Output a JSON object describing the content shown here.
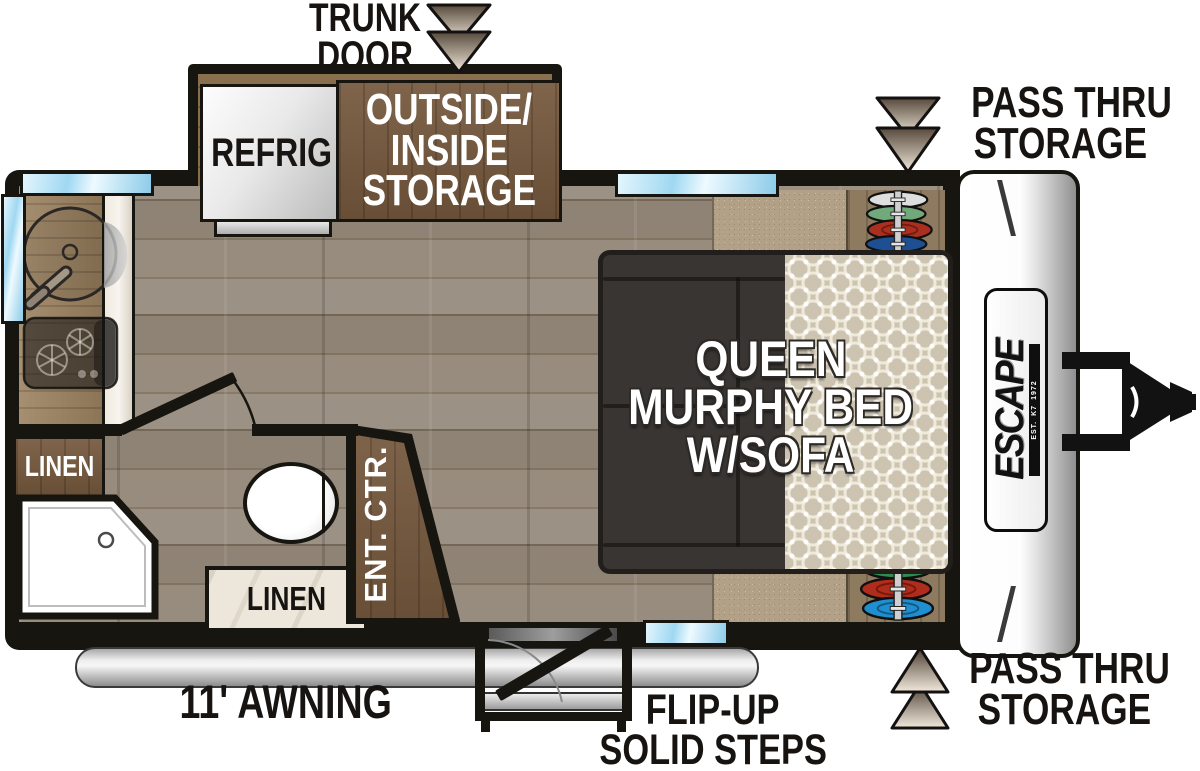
{
  "exterior": {
    "trunk_door": {
      "line1": "TRUNK",
      "line2": "DOOR"
    },
    "pass_thru_top": {
      "line1": "PASS THRU",
      "line2": "STORAGE"
    },
    "pass_thru_bottom": {
      "line1": "PASS THRU",
      "line2": "STORAGE"
    },
    "awning": "11' AWNING",
    "steps": {
      "line1": "FLIP-UP",
      "line2": "SOLID STEPS"
    }
  },
  "interior": {
    "refrigerator": "REFRIG",
    "storage": {
      "line1": "OUTSIDE/",
      "line2": "INSIDE",
      "line3": "STORAGE"
    },
    "bed": {
      "line1": "QUEEN",
      "line2": "MURPHY BED",
      "line3": "W/SOFA"
    },
    "linen_cabinet": "LINEN",
    "linen_counter": "LINEN",
    "entertainment_center": "ENT. CTR."
  },
  "brand": {
    "logo": "ESCAPE",
    "est": "EST.",
    "model_code": "K7",
    "year": "1972"
  },
  "colors": {
    "wall": "#17150f",
    "window_blue": "#9fd8f2",
    "cabinet_brown": "#74573c",
    "carpet_tan": "#b2a186",
    "sofa_dark": "#383532",
    "arrow_dark": "#574a3c",
    "arrow_light": "#f2e9dc",
    "disc_white": "#dedede",
    "disc_green_pale": "#72a97b",
    "disc_green": "#2f8c4f",
    "disc_red": "#ab2f1f",
    "disc_blue": "#1d4f92",
    "disc_blue_bright": "#1f8fd0"
  }
}
